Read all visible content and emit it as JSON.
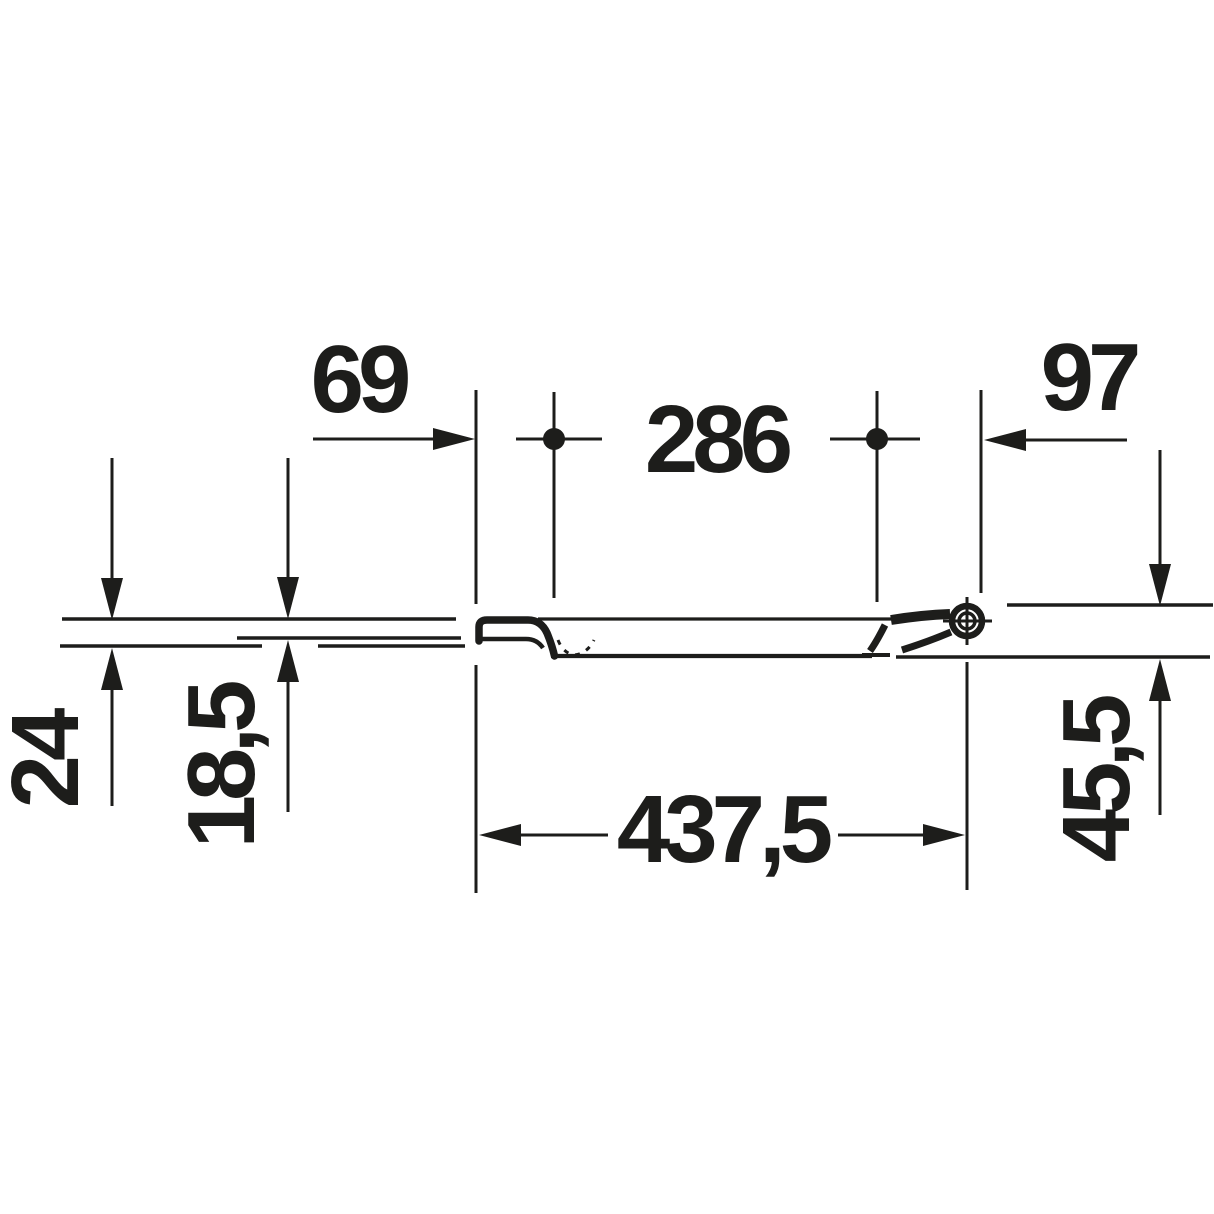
{
  "page": {
    "background": "#ffffff",
    "ink_color": "#1d1d1b",
    "unit": "mm",
    "description": "Technical side-profile dimension drawing of a toilet seat and lid with hinge"
  },
  "dimensions": {
    "front_edge_to_first_hinge_center": "69",
    "hinge_hole_spacing": "286",
    "second_hinge_center_to_rear": "97",
    "front_total_thickness": "24",
    "front_lid_thickness": "18,5",
    "overall_seat_length": "437,5",
    "rear_drop_height": "45,5"
  }
}
